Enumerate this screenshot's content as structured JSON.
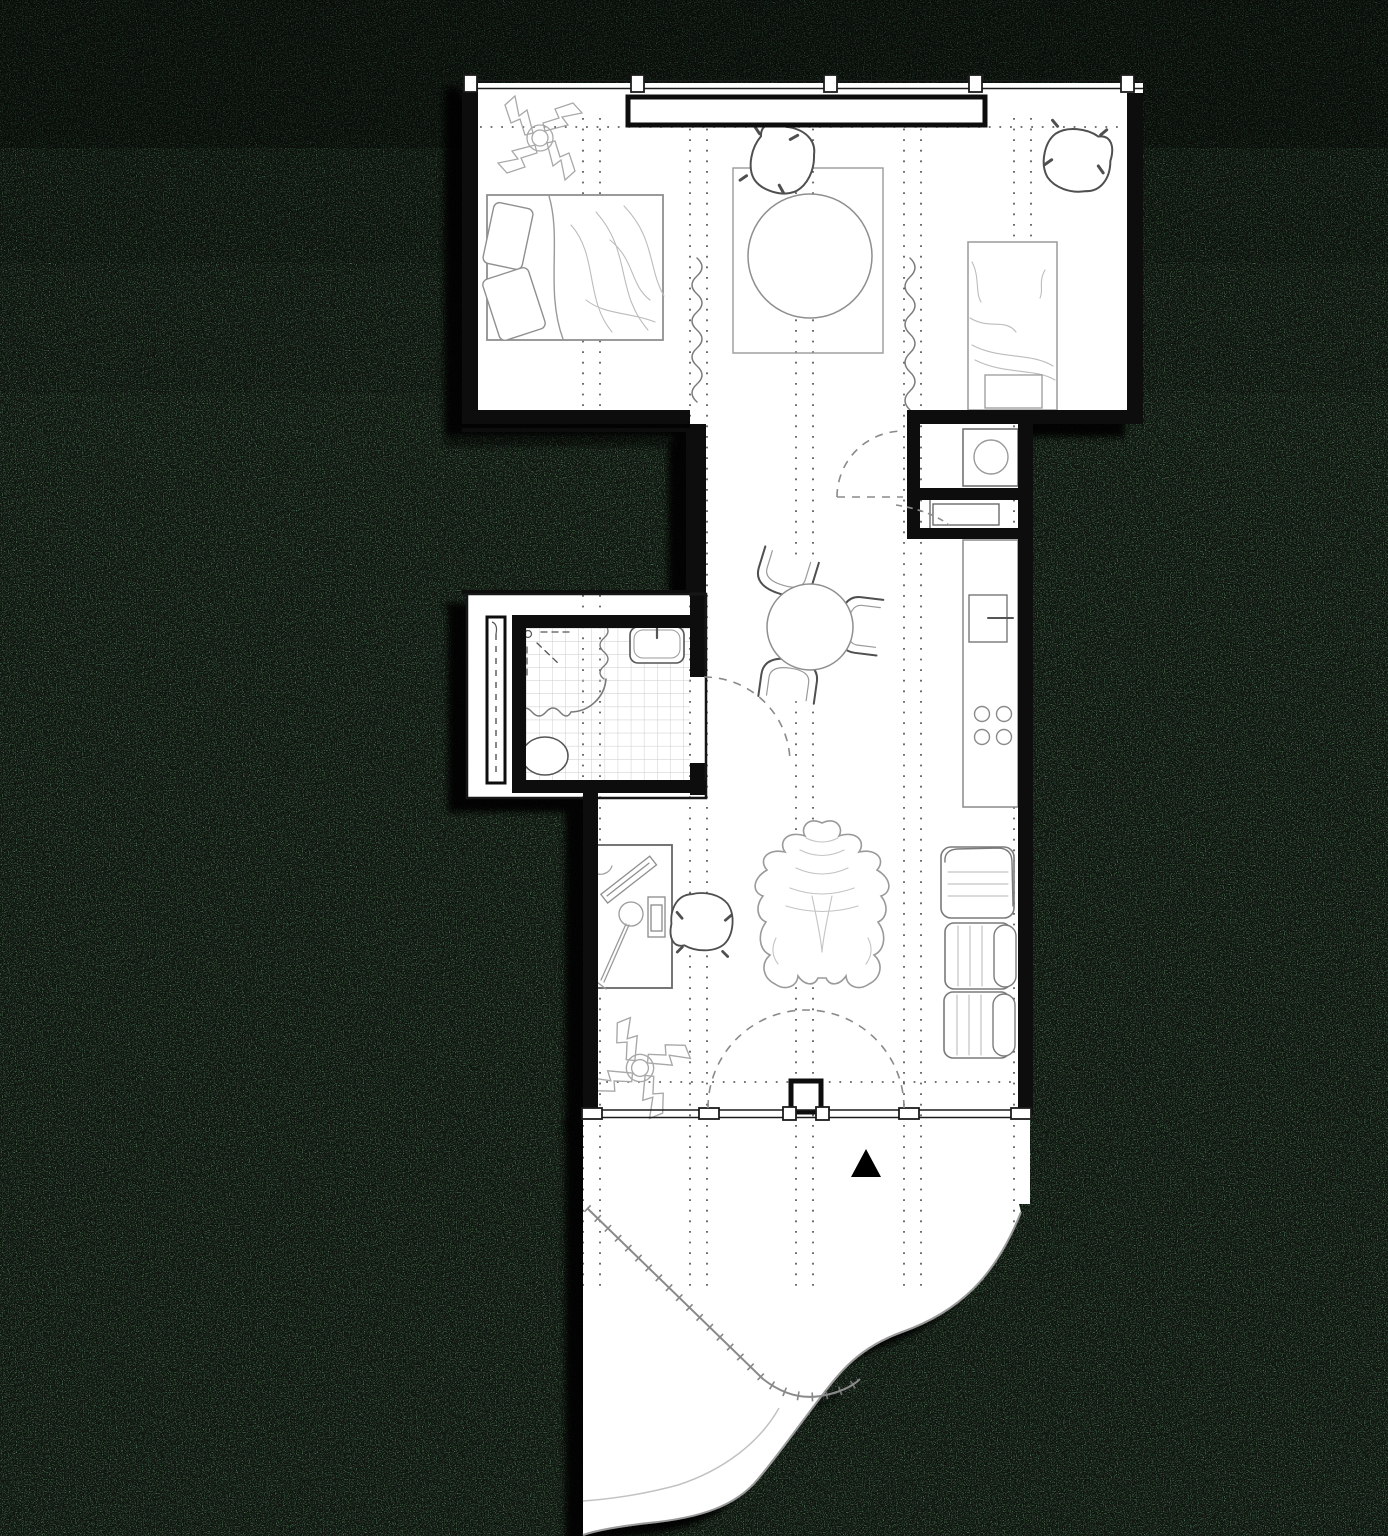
{
  "canvas": {
    "width": 1388,
    "height": 1536
  },
  "palette": {
    "background_green": "#5d7f63",
    "speckle_black": "#0a120b",
    "floor_white": "#ffffff",
    "wall_black": "#111111",
    "furniture_gray": "#8f8f8f",
    "detail_gray": "#555555",
    "soft_gray": "#b5b5b5",
    "grid_dot_gray": "#4a4a4a",
    "tile_gray": "#c9c9c9",
    "dash_gray": "#8a8a8a",
    "edge_gray": "#9a9a9a",
    "marker_black": "#000000"
  },
  "plan": {
    "type": "apartment-floor-plan",
    "rooms": [
      {
        "name": "bedroom"
      },
      {
        "name": "hallway"
      },
      {
        "name": "bathroom"
      },
      {
        "name": "laundry-closet"
      },
      {
        "name": "kitchen"
      },
      {
        "name": "living-area"
      },
      {
        "name": "terrace"
      }
    ],
    "furniture": [
      "double-bed",
      "pillows",
      "area-rug",
      "round-table",
      "lounge-chair",
      "corner-lounge-chair",
      "daybed",
      "curtain",
      "dining-table",
      "dining-chair",
      "desk",
      "desk-chair",
      "desk-lamp",
      "monitor",
      "animal-hide-rug",
      "sectional-sofa",
      "potted-plant"
    ],
    "fixtures": [
      "washing-machine",
      "wardrobe",
      "kitchen-counter",
      "kitchen-sink",
      "cooktop",
      "shower-area",
      "shower-curtain",
      "bathroom-sink",
      "toilet",
      "floor-drain",
      "tiled-floor",
      "storage-cabinet",
      "pocket-window"
    ],
    "openings": [
      "north-window-wall",
      "south-window-wall",
      "entry-double-door",
      "bathroom-door",
      "hallway-door",
      "wardrobe-sliding-door"
    ],
    "markers": [
      "entrance-triangle-marker",
      "structural-grid-lines",
      "balcony-railing",
      "terrace-edge"
    ]
  }
}
